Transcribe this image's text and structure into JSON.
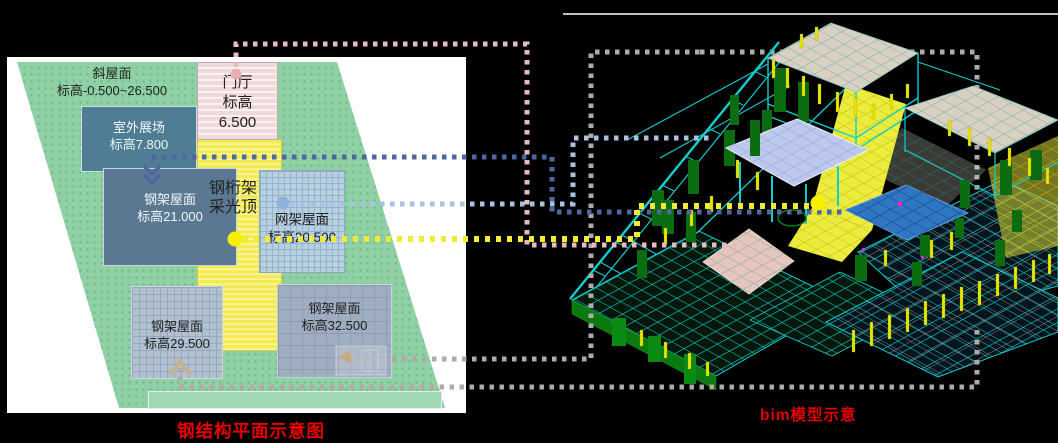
{
  "captions": {
    "plan_caption": "钢结构平面示意图",
    "model_caption": "bim模型示意"
  },
  "plan": {
    "slope_roof": {
      "name": "斜屋面",
      "elevation": "标高-0.500~26.500"
    },
    "entrance_hall": {
      "name": "门厅",
      "elevation_label": "标高",
      "elevation_value": "6.500"
    },
    "outdoor_exhibition": {
      "name": "室外展场",
      "elevation": "标高7.800"
    },
    "steel_roof_21": {
      "name": "钢架屋面",
      "elevation": "标高21.000"
    },
    "truss_skylight": {
      "line1": "钢桁架",
      "line2": "采光顶"
    },
    "space_frame_roof": {
      "name": "网架屋面",
      "elevation": "标高20.500"
    },
    "steel_roof_29": {
      "name": "钢架屋面",
      "elevation": "标高29.500"
    },
    "steel_roof_32": {
      "name": "钢架屋面",
      "elevation": "标高32.500"
    }
  },
  "colors": {
    "caption_red": "#e60000",
    "connector_pink": "#e6bcbf",
    "connector_gray": "#b3a9a7",
    "connector_dark_blue": "#4d679f",
    "connector_light_blue": "#aac2e2",
    "connector_yellow": "#f2ea34",
    "plan_green": "#8fd1a5",
    "entrance_pink": "#efd9db",
    "skylight_yellow": "#f3eb50",
    "outdoor_slate": "#4e7d94",
    "steel21_slate": "#5a7892",
    "space_frame_blue": "#b9cfe0",
    "steel29_gray": "#b2c1d1",
    "steel32_gray": "#9fadc0",
    "model_cyan": "#12cfcf",
    "model_green": "#0c7c12",
    "model_yellow": "#e6e600",
    "roof_tan": "#d9d0c2",
    "slab_lavender": "#bdc9ec",
    "slab_blue": "#2f77c2",
    "slab_pink": "#e6c5bc"
  }
}
